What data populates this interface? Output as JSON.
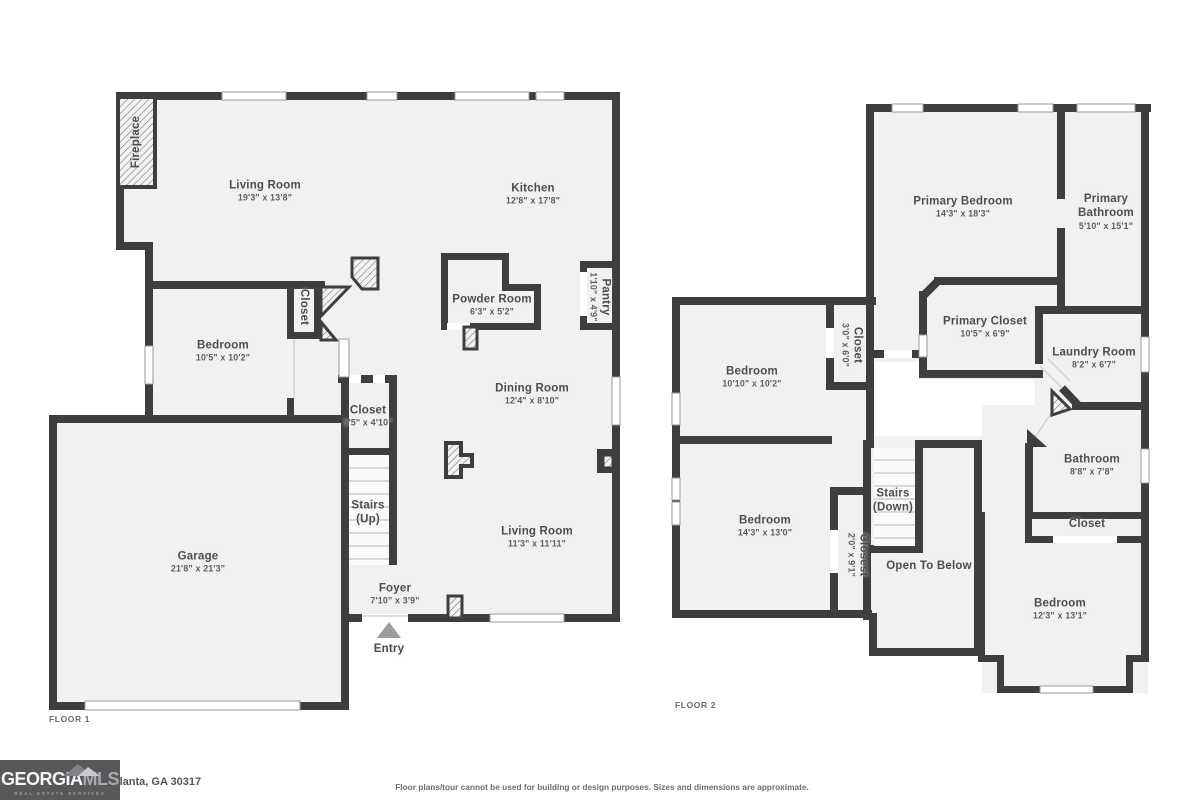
{
  "floor1": {
    "label": "FLOOR 1",
    "rooms": {
      "fireplace": {
        "name": "Fireplace"
      },
      "living_room": {
        "name": "Living Room",
        "dims": "19'3\" x 13'8\""
      },
      "kitchen": {
        "name": "Kitchen",
        "dims": "12'8\" x 17'8\""
      },
      "powder_room": {
        "name": "Powder Room",
        "dims": "6'3\" x 5'2\""
      },
      "pantry": {
        "name": "Pantry",
        "dims": "1'10\" x 4'9\""
      },
      "closet_hall": {
        "name": "Closet"
      },
      "bedroom": {
        "name": "Bedroom",
        "dims": "10'5\" x 10'2\""
      },
      "closet_stairs": {
        "name": "Closet",
        "dims": "3'5\" x 4'10\""
      },
      "stairs": {
        "name": "Stairs",
        "dims": "(Up)"
      },
      "dining_room": {
        "name": "Dining Room",
        "dims": "12'4\" x 8'10\""
      },
      "living_room2": {
        "name": "Living Room",
        "dims": "11'3\" x 11'11\""
      },
      "garage": {
        "name": "Garage",
        "dims": "21'8\" x 21'3\""
      },
      "foyer": {
        "name": "Foyer",
        "dims": "7'10\" x 3'9\""
      },
      "entry": {
        "name": "Entry"
      }
    }
  },
  "floor2": {
    "label": "FLOOR 2",
    "rooms": {
      "primary_bedroom": {
        "name": "Primary Bedroom",
        "dims": "14'3\" x 18'3\""
      },
      "primary_bathroom": {
        "name": "Primary Bathroom",
        "dims": "5'10\" x 15'1\""
      },
      "primary_closet": {
        "name": "Primary Closet",
        "dims": "10'5\" x 6'9\""
      },
      "laundry_room": {
        "name": "Laundry Room",
        "dims": "8'2\" x 6'7\""
      },
      "closet_hall": {
        "name": "Closet",
        "dims": "3'0\" x 6'0\""
      },
      "bedroom1": {
        "name": "Bedroom",
        "dims": "10'10\" x 10'2\""
      },
      "bedroom2": {
        "name": "Bedroom",
        "dims": "14'3\" x 13'0\""
      },
      "stairs": {
        "name": "Stairs",
        "dims": "(Down)"
      },
      "closest": {
        "name": "Closest",
        "dims": "2'0\" x 9'1\""
      },
      "open_below": {
        "name": "Open To Below"
      },
      "bathroom": {
        "name": "Bathroom",
        "dims": "8'8\" x 7'8\""
      },
      "closet2": {
        "name": "Closet"
      },
      "bedroom3": {
        "name": "Bedroom",
        "dims": "12'3\" x 13'1\""
      }
    }
  },
  "footer": {
    "logo_part1": "GEORGIA",
    "logo_part2": "MLS",
    "logo_sub": "REAL ESTATE SERVICES",
    "address": "Atlanta, GA 30317",
    "disclaimer": "Floor plans/tour cannot be used for building or design purposes. Sizes and dimensions are approximate."
  }
}
